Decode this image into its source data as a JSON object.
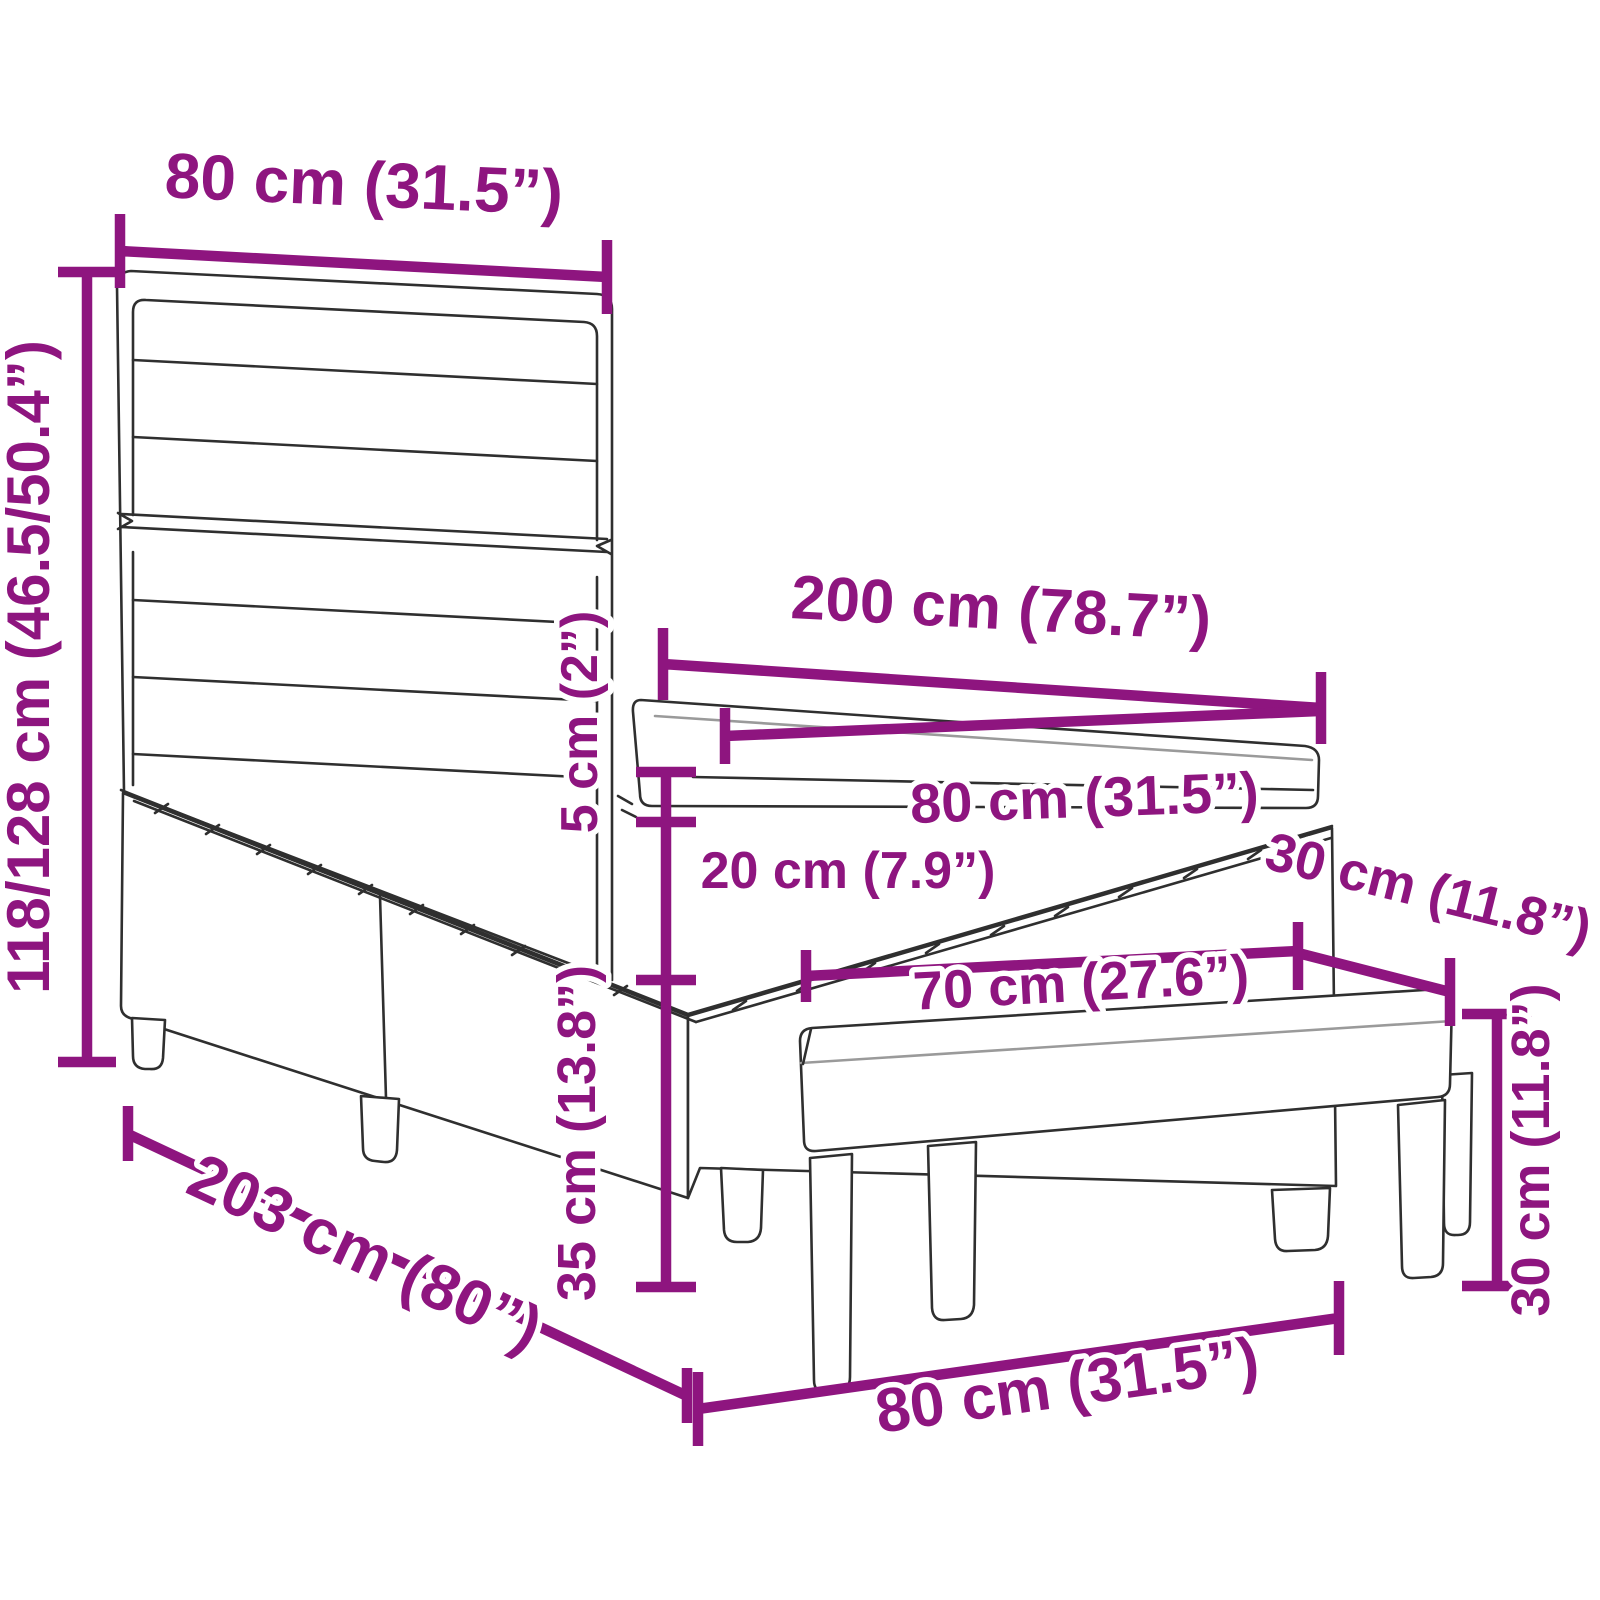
{
  "colors": {
    "dimension_accent": "#8E157F",
    "line_art": "#2F2F2F",
    "background": "#FFFFFF"
  },
  "dimensions": {
    "headboard_width": {
      "label": "80 cm (31.5”)"
    },
    "headboard_height": {
      "label": "118/128 cm (46.5/50.4”)"
    },
    "bed_length": {
      "label": "200 cm (78.7”)"
    },
    "mattress_width": {
      "label": "80 cm (31.5”)"
    },
    "topper_thickness": {
      "label": "5 cm (2”)"
    },
    "mattress_thickness": {
      "label": "20 cm (7.9”)"
    },
    "base_height": {
      "label": "35 cm (13.8”)"
    },
    "bench_length": {
      "label": "70 cm (27.6”)"
    },
    "bench_depth": {
      "label": "30 cm (11.8”)"
    },
    "bench_height": {
      "label": "30 cm (11.8”)"
    },
    "base_length": {
      "label": "203 cm (80”)"
    },
    "bed_width": {
      "label": "80 cm (31.5”)"
    }
  }
}
